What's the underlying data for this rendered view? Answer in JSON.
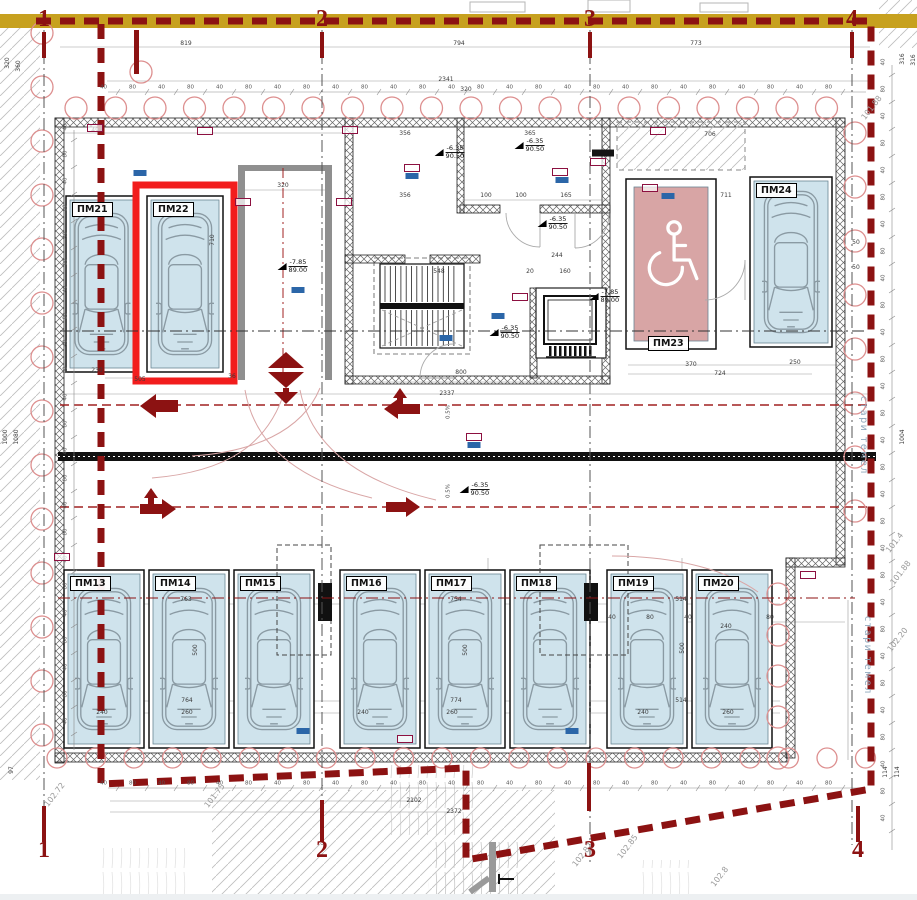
{
  "colors": {
    "boundary": "#8c1212",
    "highlight": "#f21d1d",
    "stall_fill": "#cfe3ec",
    "accessible_fill": "#d8a5a5",
    "gold_band": "#c7a11f",
    "pile": "#dd8f8f",
    "chip_blue": "#2b66a8",
    "chip_red": "#8c1040",
    "arrow": "#8c1212",
    "note_text": "#8fa8bd"
  },
  "grid": {
    "labels": [
      "1",
      "2",
      "3",
      "4"
    ],
    "top_x": [
      44,
      322,
      590,
      852
    ],
    "top_y": 19,
    "bottom_x": [
      44,
      322,
      590,
      858
    ],
    "bottom_y": 850
  },
  "stalls": [
    {
      "id": "pm21",
      "label": "ПМ21",
      "x": 66,
      "y": 196,
      "w": 71,
      "h": 176,
      "kind": "car",
      "label_pos": "top",
      "highlight": false
    },
    {
      "id": "pm22",
      "label": "ПМ22",
      "x": 147,
      "y": 196,
      "w": 76,
      "h": 176,
      "kind": "car",
      "label_pos": "top",
      "highlight": true
    },
    {
      "id": "pm23",
      "label": "ПМ23",
      "x": 626,
      "y": 179,
      "w": 90,
      "h": 170,
      "kind": "accessible",
      "label_pos": "bottom",
      "highlight": false
    },
    {
      "id": "pm24",
      "label": "ПМ24",
      "x": 750,
      "y": 177,
      "w": 82,
      "h": 170,
      "kind": "car",
      "label_pos": "top",
      "highlight": false
    },
    {
      "id": "pm13",
      "label": "ПМ13",
      "x": 64,
      "y": 570,
      "w": 80,
      "h": 178,
      "kind": "car",
      "label_pos": "top",
      "highlight": false
    },
    {
      "id": "pm14",
      "label": "ПМ14",
      "x": 149,
      "y": 570,
      "w": 80,
      "h": 178,
      "kind": "car",
      "label_pos": "top",
      "highlight": false
    },
    {
      "id": "pm15",
      "label": "ПМ15",
      "x": 234,
      "y": 570,
      "w": 80,
      "h": 178,
      "kind": "car",
      "label_pos": "top",
      "highlight": false
    },
    {
      "id": "pm16",
      "label": "ПМ16",
      "x": 340,
      "y": 570,
      "w": 80,
      "h": 178,
      "kind": "car",
      "label_pos": "top",
      "highlight": false
    },
    {
      "id": "pm17",
      "label": "ПМ17",
      "x": 425,
      "y": 570,
      "w": 80,
      "h": 178,
      "kind": "car",
      "label_pos": "top",
      "highlight": false
    },
    {
      "id": "pm18",
      "label": "ПМ18",
      "x": 510,
      "y": 570,
      "w": 80,
      "h": 178,
      "kind": "car",
      "label_pos": "top",
      "highlight": false
    },
    {
      "id": "pm19",
      "label": "ПМ19",
      "x": 607,
      "y": 570,
      "w": 80,
      "h": 178,
      "kind": "car",
      "label_pos": "top",
      "highlight": false
    },
    {
      "id": "pm20",
      "label": "ПМ20",
      "x": 692,
      "y": 570,
      "w": 80,
      "h": 178,
      "kind": "car",
      "label_pos": "top",
      "highlight": false
    }
  ],
  "level_markers": [
    {
      "value": "-6.35",
      "datum": "90.50",
      "x": 445,
      "y": 153
    },
    {
      "value": "-6.35",
      "datum": "90.50",
      "x": 525,
      "y": 146
    },
    {
      "value": "-6.35",
      "datum": "90.50",
      "x": 548,
      "y": 224
    },
    {
      "value": "-6.35",
      "datum": "90.50",
      "x": 500,
      "y": 333
    },
    {
      "value": "-6.35",
      "datum": "90.50",
      "x": 470,
      "y": 490
    },
    {
      "value": "-7.85",
      "datum": "89.00",
      "x": 288,
      "y": 267
    },
    {
      "value": "-7.85",
      "datum": "89.00",
      "x": 600,
      "y": 297
    }
  ],
  "dimensions": [
    {
      "t": "819",
      "x": 186,
      "y": 44
    },
    {
      "t": "794",
      "x": 459,
      "y": 44
    },
    {
      "t": "773",
      "x": 696,
      "y": 44
    },
    {
      "t": "2341",
      "x": 446,
      "y": 80
    },
    {
      "t": "320",
      "x": 466,
      "y": 90
    },
    {
      "t": "491",
      "x": 97,
      "y": 131
    },
    {
      "t": "320",
      "x": 283,
      "y": 186
    },
    {
      "t": "356",
      "x": 405,
      "y": 134
    },
    {
      "t": "365",
      "x": 530,
      "y": 134
    },
    {
      "t": "706",
      "x": 710,
      "y": 135
    },
    {
      "t": "711",
      "x": 726,
      "y": 196
    },
    {
      "t": "356",
      "x": 405,
      "y": 196
    },
    {
      "t": "100",
      "x": 486,
      "y": 196
    },
    {
      "t": "100",
      "x": 521,
      "y": 196
    },
    {
      "t": "165",
      "x": 566,
      "y": 196
    },
    {
      "t": "244",
      "x": 557,
      "y": 256
    },
    {
      "t": "548",
      "x": 439,
      "y": 272
    },
    {
      "t": "20",
      "x": 530,
      "y": 272
    },
    {
      "t": "160",
      "x": 565,
      "y": 272
    },
    {
      "t": "800",
      "x": 461,
      "y": 373
    },
    {
      "t": "2337",
      "x": 447,
      "y": 394
    },
    {
      "t": "230",
      "x": 97,
      "y": 371
    },
    {
      "t": "505",
      "x": 140,
      "y": 380
    },
    {
      "t": "36",
      "x": 232,
      "y": 377
    },
    {
      "t": "370",
      "x": 691,
      "y": 365
    },
    {
      "t": "250",
      "x": 795,
      "y": 363
    },
    {
      "t": "724",
      "x": 720,
      "y": 374
    },
    {
      "t": "763",
      "x": 186,
      "y": 600
    },
    {
      "t": "764",
      "x": 187,
      "y": 701
    },
    {
      "t": "754",
      "x": 456,
      "y": 600
    },
    {
      "t": "774",
      "x": 456,
      "y": 701
    },
    {
      "t": "514",
      "x": 681,
      "y": 600
    },
    {
      "t": "514",
      "x": 681,
      "y": 701
    },
    {
      "t": "240",
      "x": 102,
      "y": 713
    },
    {
      "t": "260",
      "x": 187,
      "y": 713
    },
    {
      "t": "240",
      "x": 363,
      "y": 713
    },
    {
      "t": "260",
      "x": 452,
      "y": 713
    },
    {
      "t": "240",
      "x": 643,
      "y": 713
    },
    {
      "t": "260",
      "x": 728,
      "y": 713
    },
    {
      "t": "2102",
      "x": 414,
      "y": 801
    },
    {
      "t": "2372",
      "x": 454,
      "y": 812
    },
    {
      "t": "240",
      "x": 726,
      "y": 627
    },
    {
      "t": "40",
      "x": 612,
      "y": 618
    },
    {
      "t": "80",
      "x": 650,
      "y": 618
    },
    {
      "t": "40",
      "x": 688,
      "y": 618
    },
    {
      "t": "80",
      "x": 770,
      "y": 618
    },
    {
      "t": "500",
      "x": 196,
      "y": 650,
      "r": -90
    },
    {
      "t": "500",
      "x": 466,
      "y": 650,
      "r": -90
    },
    {
      "t": "500",
      "x": 683,
      "y": 648,
      "r": -90
    },
    {
      "t": "710",
      "x": 213,
      "y": 240,
      "r": -90
    },
    {
      "t": "320",
      "x": 8,
      "y": 63,
      "r": -90
    },
    {
      "t": "360",
      "x": 19,
      "y": 66,
      "r": -90
    },
    {
      "t": "1000",
      "x": 6,
      "y": 437,
      "r": -90
    },
    {
      "t": "1080",
      "x": 17,
      "y": 437,
      "r": -90
    },
    {
      "t": "97",
      "x": 12,
      "y": 770,
      "r": -90
    },
    {
      "t": "316",
      "x": 903,
      "y": 59,
      "r": -90
    },
    {
      "t": "316",
      "x": 914,
      "y": 60,
      "r": -90
    },
    {
      "t": "1004",
      "x": 903,
      "y": 437,
      "r": -90
    },
    {
      "t": "114",
      "x": 886,
      "y": 772,
      "r": -90
    },
    {
      "t": "114",
      "x": 898,
      "y": 772,
      "r": -90
    },
    {
      "t": "50",
      "x": 856,
      "y": 243
    },
    {
      "t": "50",
      "x": 856,
      "y": 268
    }
  ],
  "spot_elevations": [
    {
      "t": "102.72",
      "x": 55,
      "y": 795
    },
    {
      "t": "101.75",
      "x": 215,
      "y": 796
    },
    {
      "t": "102.87",
      "x": 583,
      "y": 855
    },
    {
      "t": "102.85",
      "x": 628,
      "y": 847
    },
    {
      "t": "102.8",
      "x": 720,
      "y": 877
    },
    {
      "t": "101.4",
      "x": 895,
      "y": 543
    },
    {
      "t": "101.88",
      "x": 901,
      "y": 573
    },
    {
      "t": "102.20",
      "x": 898,
      "y": 640
    },
    {
      "t": "101.88",
      "x": 872,
      "y": 108
    }
  ],
  "rotated_notes": [
    {
      "t": "стари темел",
      "x": 868,
      "y": 396
    },
    {
      "t": "стари темел",
      "x": 872,
      "y": 616
    }
  ],
  "slope_labels": [
    {
      "t": "0.5%",
      "x": 449,
      "y": 412
    },
    {
      "t": "0.5%",
      "x": 449,
      "y": 491
    }
  ],
  "chips": [
    {
      "x": 140,
      "y": 173,
      "c": "b"
    },
    {
      "x": 412,
      "y": 168,
      "c": "r"
    },
    {
      "x": 412,
      "y": 176,
      "c": "b"
    },
    {
      "x": 560,
      "y": 172,
      "c": "r"
    },
    {
      "x": 562,
      "y": 180,
      "c": "b"
    },
    {
      "x": 668,
      "y": 196,
      "c": "b"
    },
    {
      "x": 650,
      "y": 188,
      "c": "r"
    },
    {
      "x": 298,
      "y": 290,
      "c": "b"
    },
    {
      "x": 446,
      "y": 338,
      "c": "b"
    },
    {
      "x": 498,
      "y": 316,
      "c": "b"
    },
    {
      "x": 474,
      "y": 437,
      "c": "r"
    },
    {
      "x": 474,
      "y": 445,
      "c": "b"
    },
    {
      "x": 572,
      "y": 731,
      "c": "b"
    },
    {
      "x": 405,
      "y": 739,
      "c": "r"
    },
    {
      "x": 303,
      "y": 731,
      "c": "b"
    },
    {
      "x": 95,
      "y": 128,
      "c": "r"
    },
    {
      "x": 205,
      "y": 131,
      "c": "r"
    },
    {
      "x": 350,
      "y": 130,
      "c": "r"
    },
    {
      "x": 658,
      "y": 131,
      "c": "r"
    },
    {
      "x": 243,
      "y": 202,
      "c": "r"
    },
    {
      "x": 344,
      "y": 202,
      "c": "r"
    },
    {
      "x": 520,
      "y": 297,
      "c": "r"
    },
    {
      "x": 62,
      "y": 557,
      "c": "r"
    },
    {
      "x": 808,
      "y": 575,
      "c": "r"
    },
    {
      "x": 603,
      "y": 153,
      "c": "k"
    },
    {
      "x": 598,
      "y": 162,
      "c": "r"
    }
  ],
  "tick_rows": [
    {
      "o": "h",
      "y": 88,
      "x0": 118,
      "x1": 856,
      "step": 29,
      "labels": [
        "40",
        "80"
      ]
    },
    {
      "o": "h",
      "y": 784,
      "x0": 118,
      "x1": 856,
      "step": 29,
      "labels": [
        "40",
        "80"
      ]
    },
    {
      "o": "v",
      "x": 70,
      "y0": 140,
      "y1": 740,
      "step": 27,
      "labels": [
        "40",
        "80"
      ]
    },
    {
      "o": "v",
      "x": 888,
      "y0": 75,
      "y1": 840,
      "step": 27,
      "labels": [
        "40",
        "80"
      ]
    }
  ]
}
